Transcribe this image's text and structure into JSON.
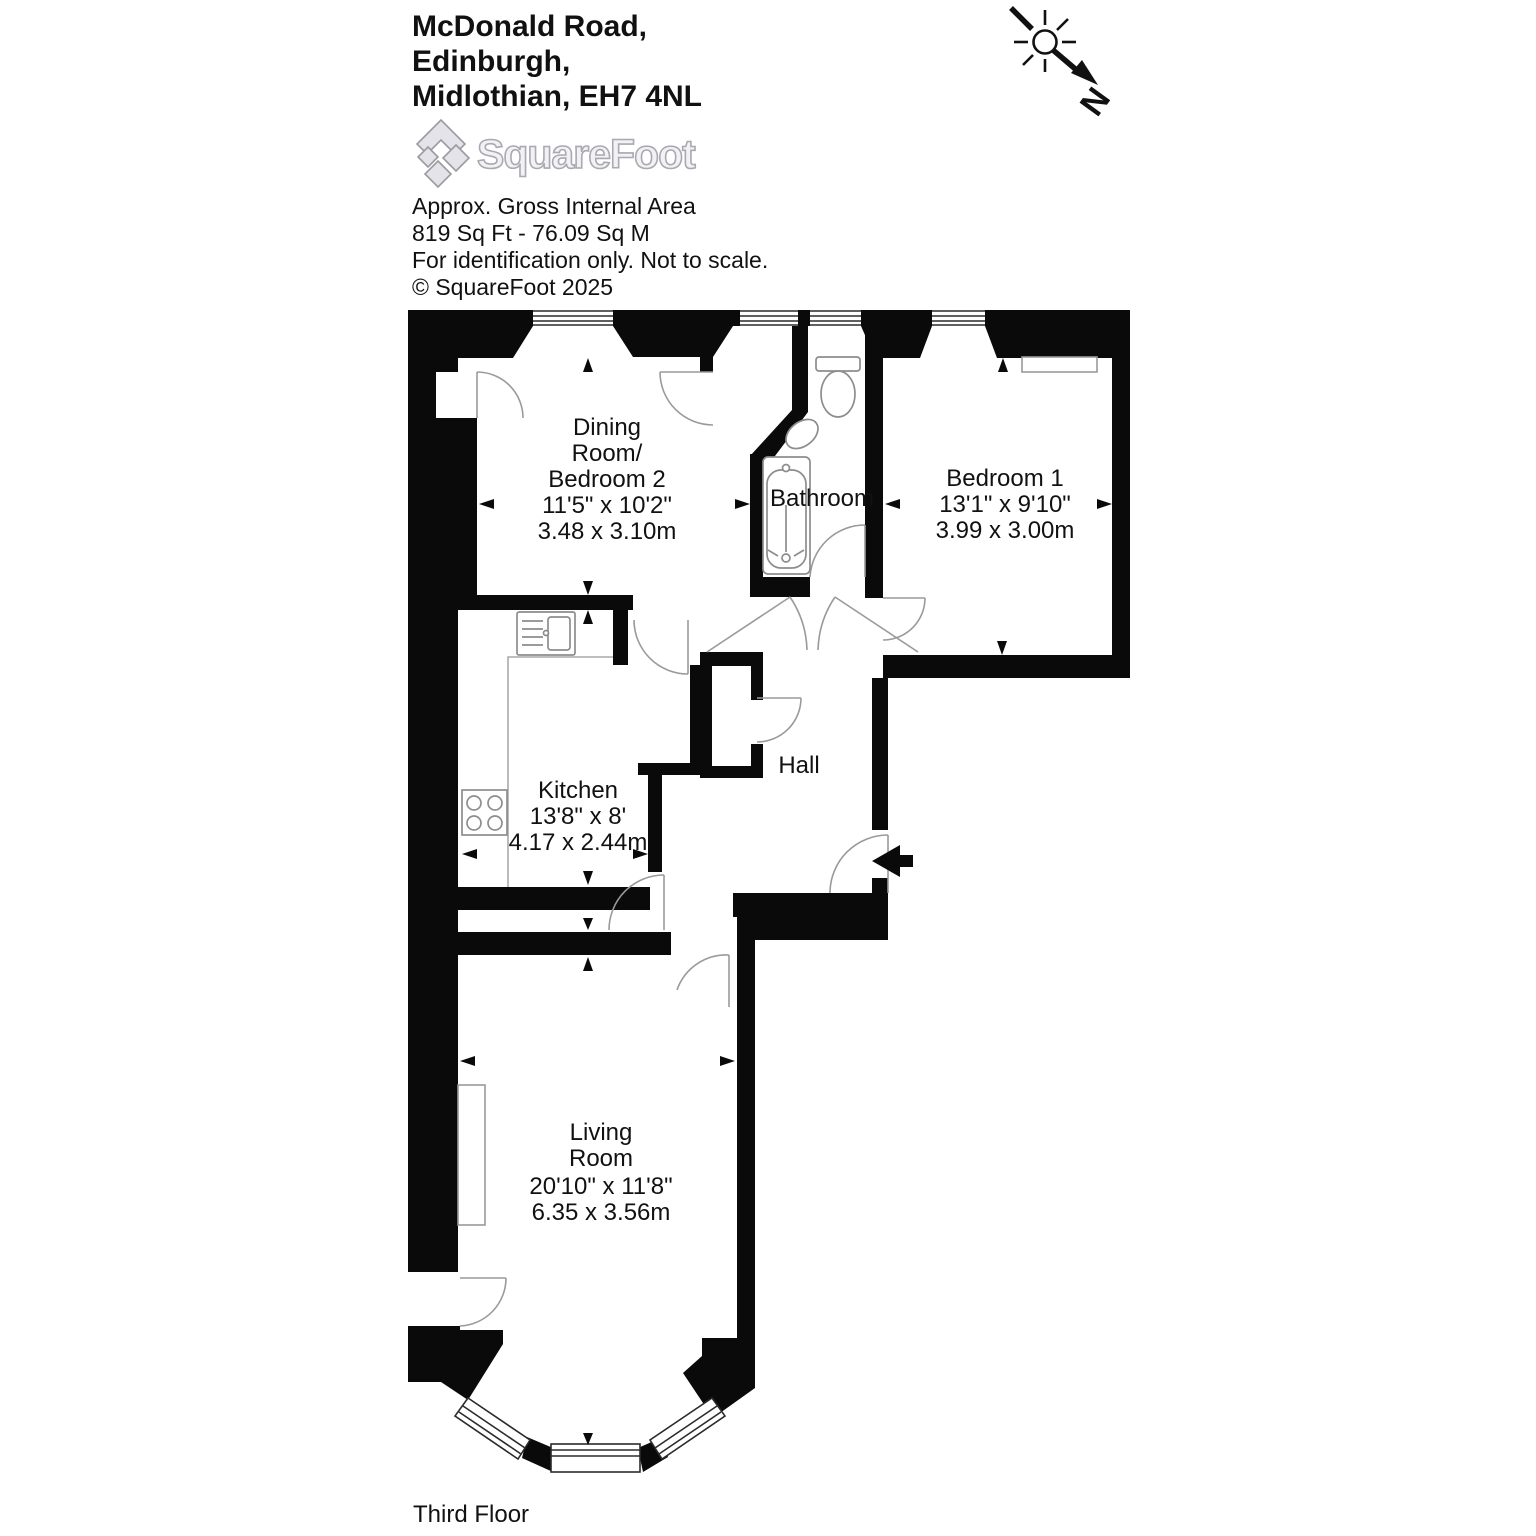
{
  "header": {
    "address_line1": "McDonald Road,",
    "address_line2": "Edinburgh,",
    "address_line3": "Midlothian, EH7 4NL"
  },
  "logo": {
    "brand": "SquareFoot"
  },
  "meta": {
    "area_title": "Approx. Gross Internal Area",
    "area_values": "819 Sq Ft - 76.09 Sq M",
    "disclaimer": "For identification only. Not to scale.",
    "copyright": "© SquareFoot 2025"
  },
  "compass": {
    "north_label": "N"
  },
  "rooms": {
    "dining": {
      "name_line1": "Dining",
      "name_line2": "Room/",
      "name_line3": "Bedroom 2",
      "imperial": "11'5\" x 10'2\"",
      "metric": "3.48 x 3.10m"
    },
    "bathroom": {
      "name": "Bathroom"
    },
    "bedroom1": {
      "name": "Bedroom 1",
      "imperial": "13'1\" x 9'10\"",
      "metric": "3.99 x 3.00m"
    },
    "kitchen": {
      "name": "Kitchen",
      "imperial": "13'8\" x 8'",
      "metric": "4.17 x 2.44m"
    },
    "hall": {
      "name": "Hall"
    },
    "living": {
      "name_line1": "Living",
      "name_line2": "Room",
      "imperial": "20'10\" x 11'8\"",
      "metric": "6.35 x 3.56m"
    }
  },
  "floor_label": "Third Floor"
}
